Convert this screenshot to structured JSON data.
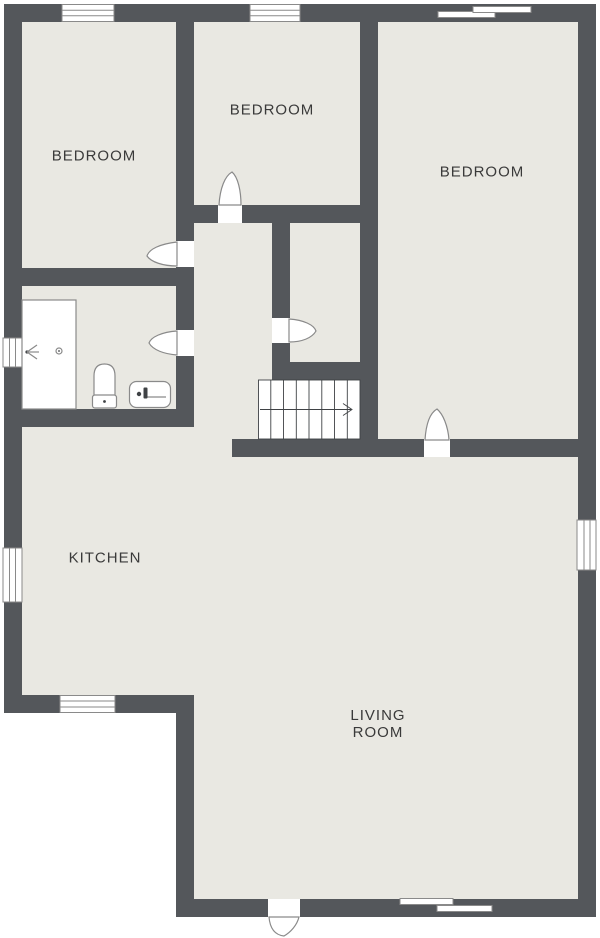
{
  "plan": {
    "type": "floor-plan",
    "rooms": [
      {
        "id": "bedroom-left",
        "label": "BEDROOM"
      },
      {
        "id": "bedroom-top",
        "label": "BEDROOM"
      },
      {
        "id": "bedroom-right",
        "label": "BEDROOM"
      },
      {
        "id": "kitchen",
        "label": "KITCHEN"
      },
      {
        "id": "living-room",
        "label": "LIVING ROOM"
      }
    ],
    "fixtures": [
      {
        "id": "shower",
        "name": "shower enclosure"
      },
      {
        "id": "toilet",
        "name": "toilet"
      },
      {
        "id": "sink",
        "name": "sink"
      }
    ],
    "stairs": {
      "treads": 8,
      "direction_arrow": "right"
    },
    "doors": [
      {
        "id": "left-bedroom-door"
      },
      {
        "id": "top-bedroom-door"
      },
      {
        "id": "closet-door"
      },
      {
        "id": "bathroom-door"
      },
      {
        "id": "right-bedroom-door"
      },
      {
        "id": "front-door"
      }
    ],
    "windows": [
      {
        "id": "top-window-left-bedroom"
      },
      {
        "id": "top-window-top-bedroom"
      },
      {
        "id": "top-sliding-window-right-bedroom"
      },
      {
        "id": "left-window-bathroom"
      },
      {
        "id": "left-window-kitchen"
      },
      {
        "id": "bottom-window-kitchen"
      },
      {
        "id": "bottom-sliding-window-living-room"
      },
      {
        "id": "right-window-living-room"
      }
    ],
    "colors": {
      "wall": "#54575b",
      "floor": "#e9e8e2",
      "background": "#ffffff",
      "label": "#3a3a3a",
      "outline": "#8a8a8a",
      "detail": "#3f4245"
    }
  }
}
